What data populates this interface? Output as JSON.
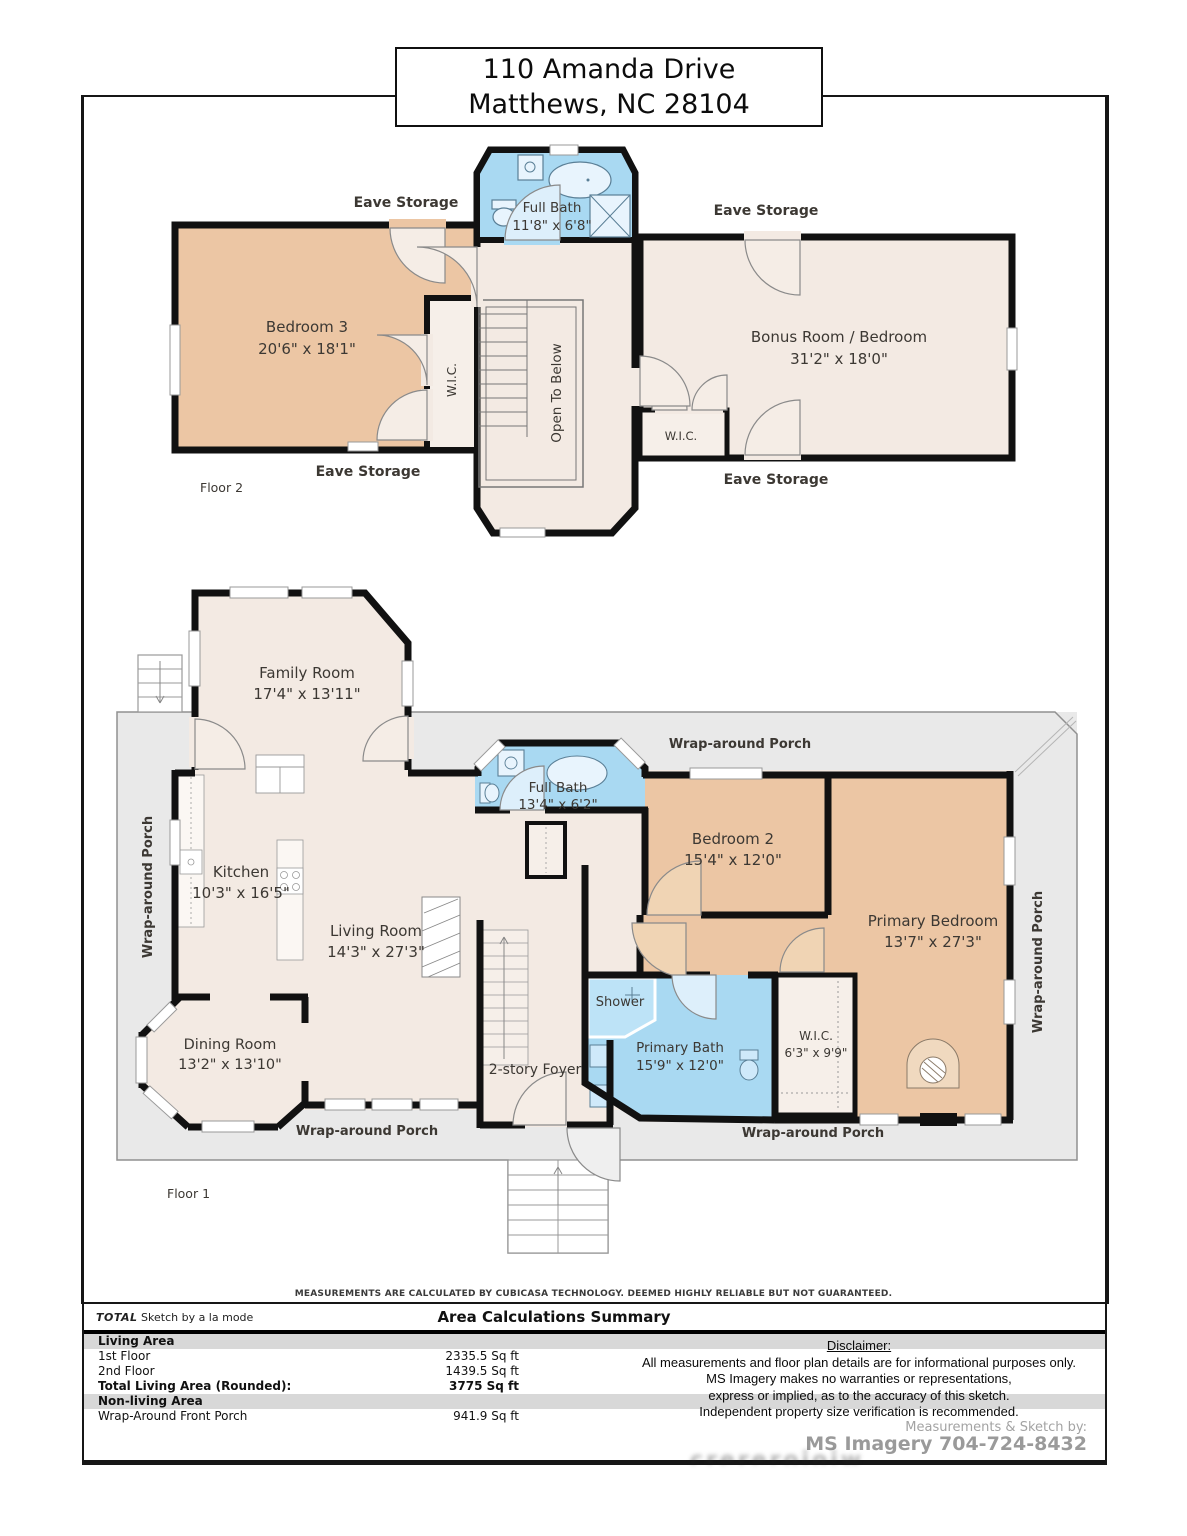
{
  "title": {
    "line1": "110 Amanda Drive",
    "line2": "Matthews, NC 28104"
  },
  "colors": {
    "wall": "#111111",
    "room_beige": "#f3eae3",
    "bedroom_tan": "#ecc6a4",
    "bath_blue": "#a9d9f2",
    "porch_gray": "#e9e9e9"
  },
  "floor2": {
    "label": "Floor 2",
    "eave_label": "Eave Storage",
    "bedroom3": {
      "name": "Bedroom 3",
      "dims": "20'6\" x 18'1\""
    },
    "full_bath": {
      "name": "Full Bath",
      "dims": "11'8\" x 6'8\""
    },
    "bonus": {
      "name": "Bonus Room / Bedroom",
      "dims": "31'2\" x 18'0\""
    },
    "wic": "W.I.C.",
    "bonus_wic": "W.I.C.",
    "open_to_below": "Open To Below"
  },
  "floor1": {
    "label": "Floor 1",
    "porch_label": "Wrap-around Porch",
    "family": {
      "name": "Family Room",
      "dims": "17'4\" x 13'11\""
    },
    "kitchen": {
      "name": "Kitchen",
      "dims": "10'3\" x 16'5\""
    },
    "living": {
      "name": "Living Room",
      "dims": "14'3\" x 27'3\""
    },
    "dining": {
      "name": "Dining Room",
      "dims": "13'2\" x 13'10\""
    },
    "full_bath": {
      "name": "Full Bath",
      "dims": "13'4\" x 6'2\""
    },
    "bedroom2": {
      "name": "Bedroom 2",
      "dims": "15'4\" x 12'0\""
    },
    "primary_bedroom": {
      "name": "Primary Bedroom",
      "dims": "13'7\" x 27'3\""
    },
    "primary_bath": {
      "name": "Primary Bath",
      "dims": "15'9\" x 12'0\""
    },
    "wic": {
      "name": "W.I.C.",
      "dims": "6'3\" x 9'9\""
    },
    "shower": "Shower",
    "foyer": "2-story Foyer"
  },
  "footer": {
    "measurement_note": "MEASUREMENTS ARE CALCULATED BY CUBICASA TECHNOLOGY. DEEMED HIGHLY RELIABLE BUT NOT GUARANTEED.",
    "brand_total": "TOTAL",
    "brand_rest": " Sketch by a la mode",
    "summary_title": "Area Calculations Summary",
    "table": {
      "living_area": "Living Area",
      "first_floor": "1st Floor",
      "first_floor_value": "2335.5 Sq ft",
      "second_floor": "2nd Floor",
      "second_floor_value": "1439.5 Sq ft",
      "total": "Total Living Area (Rounded):",
      "total_value": "3775 Sq ft",
      "nonliving": "Non-living Area",
      "porch": "Wrap-Around Front Porch",
      "porch_value": "941.9 Sq ft"
    },
    "disclaimer": {
      "heading": "Disclaimer:",
      "line1": "All measurements and floor plan details are for informational purposes only.",
      "line2": "MS Imagery makes no warranties or representations,",
      "line3": "express or implied, as to the accuracy of this sketch.",
      "line4": "Independent property size verification is recommended.",
      "credit_label": "Measurements & Sketch by:",
      "credit_value": "MS Imagery  704-724-8432"
    }
  }
}
